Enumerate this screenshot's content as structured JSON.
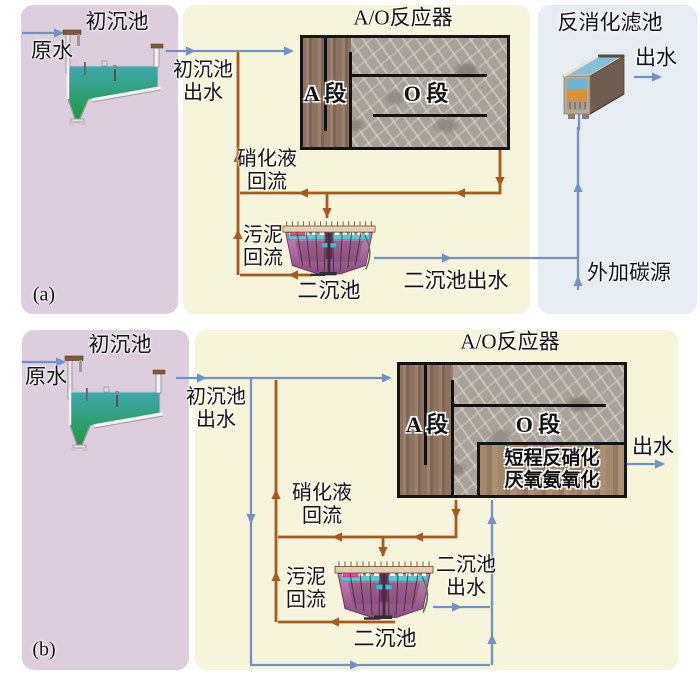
{
  "colors": {
    "panel_pink": "#ddcede",
    "panel_cream": "#f7f4dc",
    "panel_blue": "#e8edf4",
    "flow_blue": "#7291c6",
    "flow_brown": "#a9591c",
    "reactor_wood": "#8a7260",
    "reactor_stone": "#a69f97",
    "anammox_brown": "#a08266",
    "clarifier_purple": "#a965a0",
    "tank_water_teal": "#2f9fa8",
    "filter_media_orange": "#d6933f"
  },
  "panel_a": {
    "tag": "(a)",
    "primary_title": "初沉池",
    "raw_water": "原水",
    "primary_effluent": [
      "初沉池",
      "出水"
    ],
    "reactor_title": "A/O反应器",
    "section_a": "A 段",
    "section_o": "O 段",
    "nitrified_return": [
      "硝化液",
      "回流"
    ],
    "sludge_return": [
      "污泥",
      "回流"
    ],
    "clarifier": "二沉池",
    "clarifier_effluent": "二沉池出水",
    "filter_title": "反消化滤池",
    "filter_effluent": "出水",
    "carbon_source": "外加碳源"
  },
  "panel_b": {
    "tag": "(b)",
    "primary_title": "初沉池",
    "raw_water": "原水",
    "primary_effluent": [
      "初沉池",
      "出水"
    ],
    "reactor_title": "A/O反应器",
    "section_a": "A 段",
    "section_o": "O 段",
    "anammox": [
      "短程反硝化",
      "厌氧氨氧化"
    ],
    "nitrified_return": [
      "硝化液",
      "回流"
    ],
    "sludge_return": [
      "污泥",
      "回流"
    ],
    "clarifier": "二沉池",
    "clarifier_effluent": [
      "二沉池",
      "出水"
    ],
    "effluent": "出水"
  }
}
